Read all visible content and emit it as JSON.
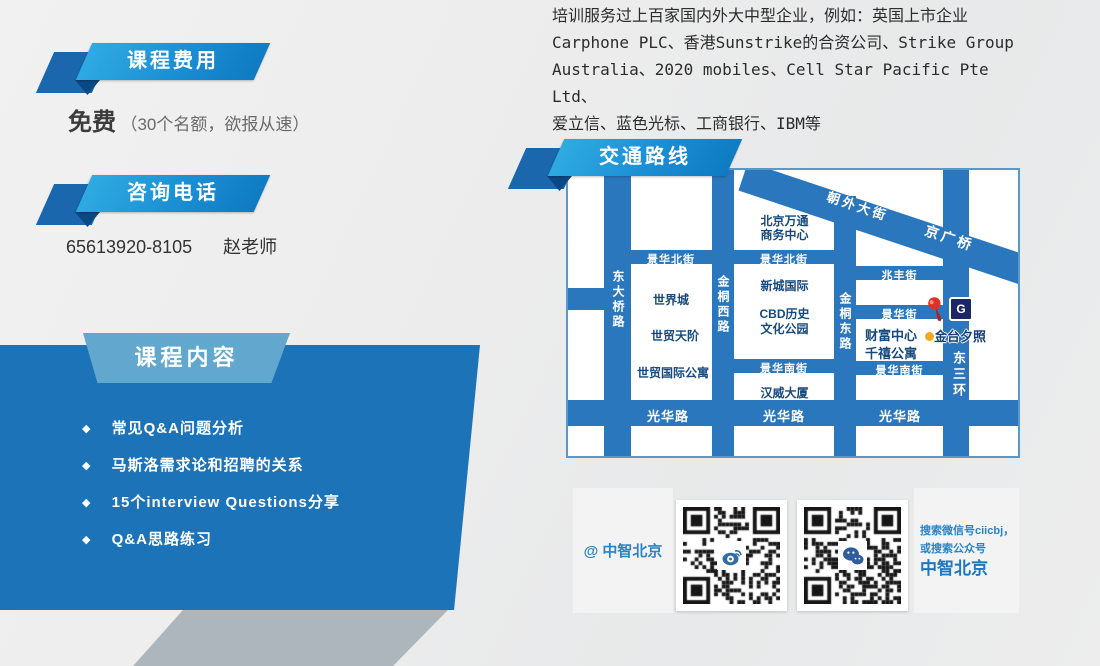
{
  "intro": {
    "lines": [
      "培训服务过上百家国内外大中型企业，例如：英国上市企业",
      "Carphone PLC、香港Sunstrike的合资公司、Strike Group",
      "Australia、2020 mobiles、Cell Star Pacific Pte Ltd、",
      "爱立信、蓝色光标、工商银行、IBM等"
    ]
  },
  "fee": {
    "banner": "课程费用",
    "value": "免费",
    "note": "（30个名额，欲报从速）"
  },
  "phone": {
    "banner": "咨询电话",
    "number": "65613920-8105",
    "contact": "赵老师"
  },
  "content": {
    "banner": "课程内容",
    "bullet": "◆",
    "items": [
      "常见Q&A问题分析",
      "马斯洛需求论和招聘的关系",
      "15个interview Questions分享",
      "Q&A思路练习"
    ]
  },
  "route": {
    "banner": "交通路线"
  },
  "map": {
    "roads": {
      "dongdaqiao": "东大桥路",
      "jintong_west": "金桐西路",
      "jintong_east": "金桐东路",
      "east_third_ring": "东三环",
      "chaowai": "朝外大街",
      "jingguang_bridge": "京广桥",
      "jinghua_north": "景华北街",
      "zhaofeng": "兆丰街",
      "jinghua": "景华街",
      "jinghua_south": "景华南街",
      "guanghua": "光华路"
    },
    "places": {
      "wantong_line1": "北京万通",
      "wantong_line2": "商务中心",
      "world_city": "世界城",
      "shimao_tianjie": "世贸天阶",
      "shimao_intl_apt": "世贸国际公寓",
      "xincheng_intl": "新城国际",
      "cbd_line1": "CBD历史",
      "cbd_line2": "文化公园",
      "hanwei": "汉威大厦",
      "fortune_center": "财富中心",
      "millennium_apt": "千禧公寓",
      "jintai_xizhao": "金台夕照"
    },
    "subway_glyph": "G"
  },
  "social": {
    "weibo_handle": "@ 中智北京",
    "search_line1": "搜索微信号ciicbj，",
    "search_line2": "或搜索公众号",
    "search_line3": "中智北京"
  },
  "icons": {
    "subway": "beijing-subway-icon",
    "pin": "map-pin-icon",
    "location_dot": "location-dot-icon",
    "weibo": "weibo-logo-icon",
    "wechat": "wechat-logo-icon"
  },
  "colors": {
    "content_box_blue": "#1d73b8",
    "road_blue": "#2b77bd",
    "ribbon_light": "#2fabe1",
    "ribbon_dark": "#0e7ac2",
    "ribbon_back": "#1a67ae",
    "map_text_blue": "#16497e",
    "link_blue": "#2a84c8",
    "gray_band": "#aeb6bd",
    "pin_red": "#d92b1c",
    "dot_yellow": "#f7a81e"
  }
}
